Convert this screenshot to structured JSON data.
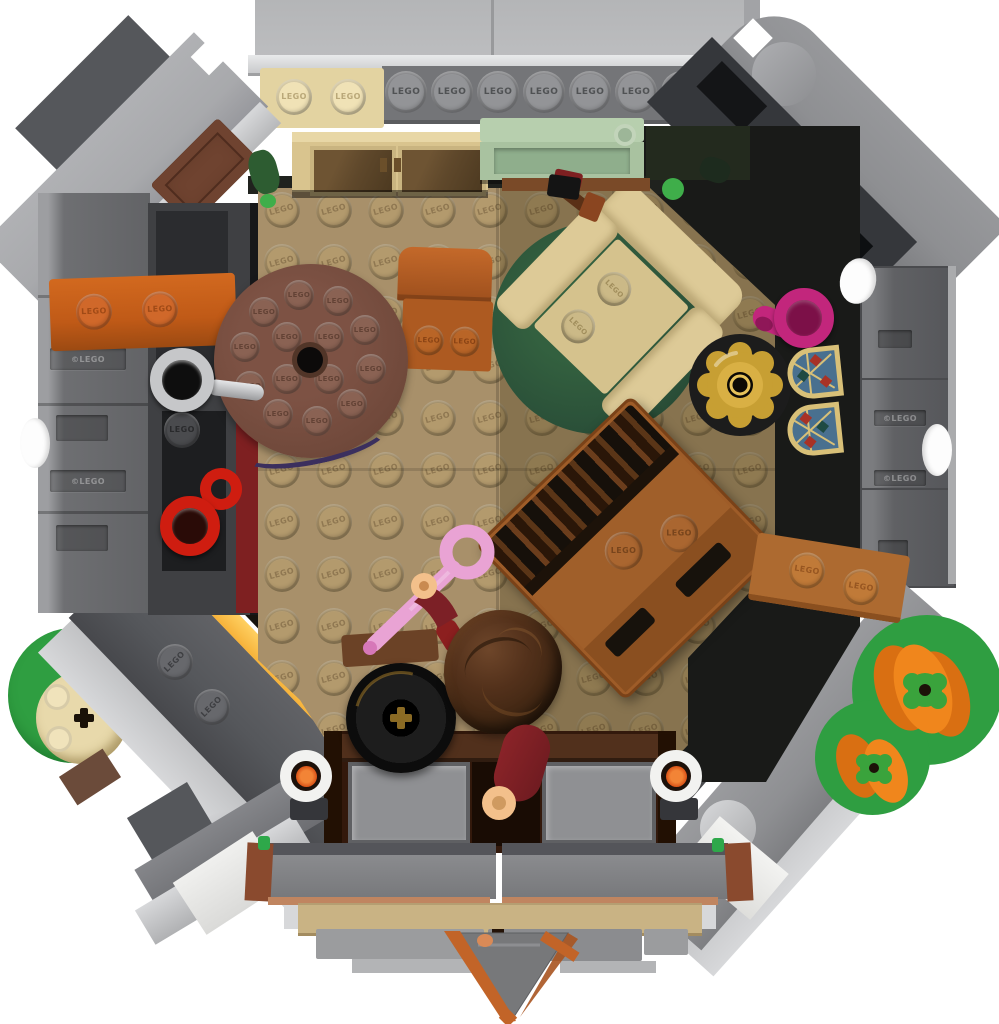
{
  "meta": {
    "subject": "LEGO octagonal hut interior photographed from directly above (top-down product photo)",
    "background": "#ffffff"
  },
  "branding": {
    "stud_text": "LEGO",
    "copyright_text": "©LEGO"
  },
  "palette": {
    "background": "#ffffff",
    "roof_panel": "#bcbdbf",
    "roof_panel_edge": "#98999b",
    "silver": "#d7d8da",
    "silver_light": "#e9eaeb",
    "slope_light": "#a8a9ac",
    "slope_mid": "#8e8f92",
    "slope_dark": "#55575b",
    "charcoal": "#35373b",
    "black_part": "#141517",
    "wall_gray": "#6e6f72",
    "wall_gray_light": "#9d9ea1",
    "wall_dark": "#3f4043",
    "wall_recess": "#1d1e20",
    "stud_gray": "#939497",
    "plate_gray": "#747578",
    "floor_tan": "#a8906a",
    "floor_stud": "#b39a6d",
    "floor_dark": "#8d7953",
    "entrance_brown": "#33190c",
    "entrance_trim": "#51301c",
    "doormat": "#8f9093",
    "table_brown": "#6f483a",
    "table_stud": "#8a6253",
    "table_rim_blue": "#3b2f5e",
    "chair_orange": "#ad5a21",
    "chair_orange_dark": "#9d4f1d",
    "cabinet_cream": "#e3d3a1",
    "cabinet_tan": "#d9c48e",
    "glass_brown": "#5f482b",
    "bench_green": "#a9c2a0",
    "bench_green_light": "#b7cfae",
    "bench_green_dark": "#8fae8c",
    "rug_green": "#2a4f38",
    "armchair_cream": "#ddca97",
    "armchair_seat": "#d5c28d",
    "armchair_stud": "#cbb987",
    "book_gold": "#c79b2e",
    "book_black": "#12161b",
    "book_blue": "#aecce6",
    "lamp_gold": "#c79f33",
    "lamp_gold_light": "#d9b044",
    "jug_magenta": "#c2267c",
    "jug_dark": "#7c1048",
    "glass_frame": "#d8c078",
    "glass_blue": "#49708f",
    "glass_red": "#a83226",
    "glass_teal": "#1f4a42",
    "dresser_brown": "#9e5c28",
    "dresser_dark": "#7a4218",
    "books_brown": "#46290f",
    "shelf_nougat": "#ad6a30",
    "barrel_black": "#161616",
    "barrel_gold": "#8a6a24",
    "hair_brown": "#4e2e1a",
    "dark_red": "#7c2026",
    "skin": "#f3c08b",
    "umbrella_pink": "#e9a3d4",
    "umbrella_pink_dark": "#d678b8",
    "bench_yellow": "#f6b23a",
    "stud_orange_warm": "#e08428",
    "mug_silver": "#c6c7c9",
    "mug_red": "#cf1d10",
    "brick_orange": "#c05a17",
    "brick_orange_stud": "#d0682a",
    "green_plate": "#2f9e41",
    "pumpkin": "#f0861c",
    "pumpkin_cap": "#3aa33c",
    "dark_red_strip": "#7e2021",
    "brown_strip": "#8a4a2e",
    "candle_white": "#f2f2f0",
    "flame": "#e5531c",
    "gable_gray": "#77787a",
    "gable_orange": "#c26428",
    "step_tan": "#c9b384",
    "leaf_green": "#2d5c31"
  },
  "objects": [
    {
      "name": "octagonal-hut-shell",
      "color": "#8e8f92"
    },
    {
      "name": "roof-panel-left",
      "color": "#bcbdbf"
    },
    {
      "name": "roof-panel-right",
      "color": "#bcbdbf"
    },
    {
      "name": "stud-plate-row",
      "color": "#747578"
    },
    {
      "name": "glass-door-cabinet",
      "color": "#d9c48e"
    },
    {
      "name": "sand-green-shelf",
      "color": "#a9c2a0"
    },
    {
      "name": "round-wooden-table",
      "color": "#6f483a"
    },
    {
      "name": "wooden-chair",
      "color": "#ad5a21"
    },
    {
      "name": "tan-armchair",
      "color": "#ddca97"
    },
    {
      "name": "round-green-rug",
      "color": "#2a4f38"
    },
    {
      "name": "golden-spellbook",
      "color": "#c79b2e"
    },
    {
      "name": "gold-lamp",
      "color": "#c79f33"
    },
    {
      "name": "magenta-jug",
      "color": "#c2267c"
    },
    {
      "name": "stained-glass-windows",
      "color": "#49708f",
      "count": 2
    },
    {
      "name": "wooden-dresser-with-books",
      "color": "#9e5c28"
    },
    {
      "name": "wall-shelf",
      "color": "#ad6a30"
    },
    {
      "name": "silver-mug",
      "color": "#c6c7c9"
    },
    {
      "name": "red-mug",
      "color": "#cf1d10"
    },
    {
      "name": "orange-wall-bracket",
      "color": "#c05a17"
    },
    {
      "name": "black-cauldron",
      "color": "#161616"
    },
    {
      "name": "yellow-ladder-bench",
      "color": "#f6b23a"
    },
    {
      "name": "minifigure-bushy-hair",
      "color": "#4e2e1a"
    },
    {
      "name": "minifigure-dark-red-outfit",
      "color": "#7c2026"
    },
    {
      "name": "pink-umbrella",
      "color": "#e9a3d4"
    },
    {
      "name": "white-candles",
      "color": "#f2f2f0",
      "count": 2
    },
    {
      "name": "pumpkins",
      "color": "#f0861c",
      "count": 2
    },
    {
      "name": "green-garden-plates",
      "color": "#2f9e41"
    },
    {
      "name": "tree-stump-round-brick",
      "color": "#e8d9ab"
    },
    {
      "name": "entrance-hall",
      "color": "#33190c"
    },
    {
      "name": "doormats",
      "color": "#8f9093",
      "count": 2
    },
    {
      "name": "front-steps",
      "color": "#c9b384"
    },
    {
      "name": "porch-gable",
      "color": "#c26428"
    }
  ]
}
